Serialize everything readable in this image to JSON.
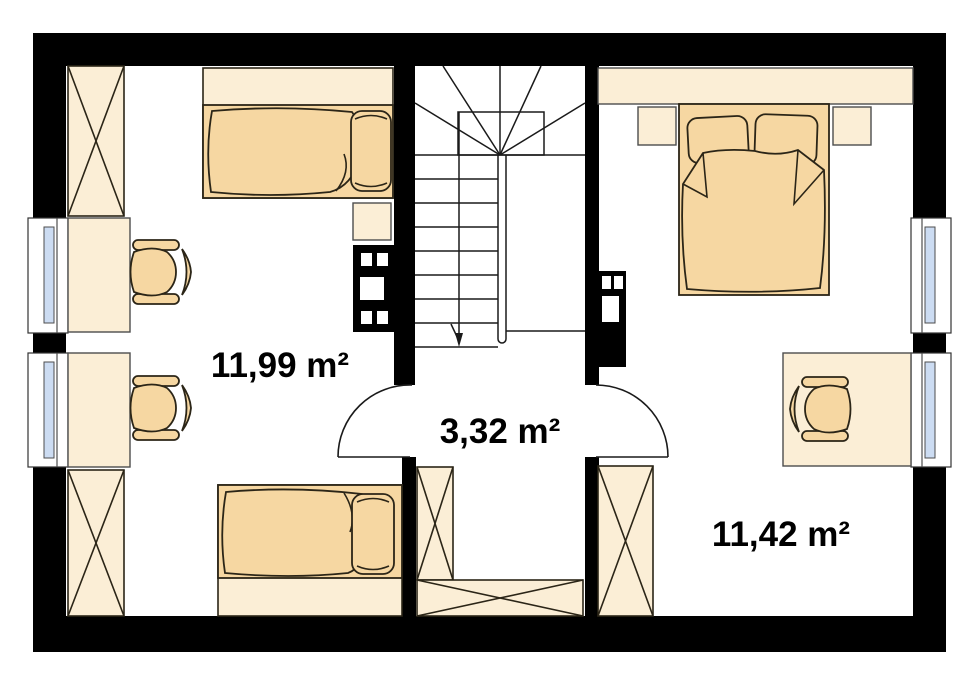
{
  "plan": {
    "type": "floor-plan",
    "rooms": [
      {
        "id": "bedroom-left",
        "area_label": "11,99 m²"
      },
      {
        "id": "hall",
        "area_label": "3,32 m²"
      },
      {
        "id": "bedroom-right",
        "area_label": "11,42 m²"
      }
    ],
    "colors": {
      "wall": "#000000",
      "furniture-light": "#fbeed6",
      "furniture-dark": "#f6d7a2",
      "glass": "#ccdcf2",
      "outline": "#2b2517",
      "frame-gray": "#4d4d4d",
      "paper": "#ffffff"
    }
  }
}
